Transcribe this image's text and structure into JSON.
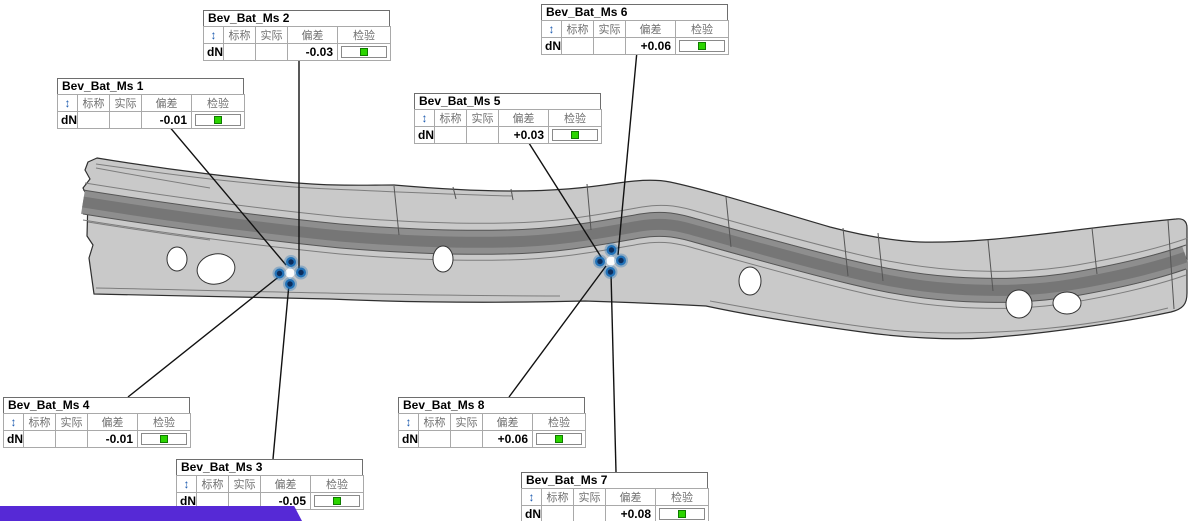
{
  "report": {
    "row_label": "dN",
    "columns": {
      "direction": "↕",
      "nominal": "标称",
      "actual": "实际",
      "deviation": "偏差",
      "check": "检验"
    },
    "callouts": [
      {
        "title": "Bev_Bat_Ms 1",
        "nominal": "",
        "actual": "",
        "deviation": "-0.01",
        "check_pass": true
      },
      {
        "title": "Bev_Bat_Ms 2",
        "nominal": "",
        "actual": "",
        "deviation": "-0.03",
        "check_pass": true
      },
      {
        "title": "Bev_Bat_Ms 3",
        "nominal": "",
        "actual": "",
        "deviation": "-0.05",
        "check_pass": true
      },
      {
        "title": "Bev_Bat_Ms 4",
        "nominal": "",
        "actual": "",
        "deviation": "-0.01",
        "check_pass": true
      },
      {
        "title": "Bev_Bat_Ms 5",
        "nominal": "",
        "actual": "",
        "deviation": "+0.03",
        "check_pass": true
      },
      {
        "title": "Bev_Bat_Ms 6",
        "nominal": "",
        "actual": "",
        "deviation": "+0.06",
        "check_pass": true
      },
      {
        "title": "Bev_Bat_Ms 7",
        "nominal": "",
        "actual": "",
        "deviation": "+0.08",
        "check_pass": true
      },
      {
        "title": "Bev_Bat_Ms 8",
        "nominal": "",
        "actual": "",
        "deviation": "+0.06",
        "check_pass": true
      }
    ]
  },
  "colors": {
    "accent_bar": "#5629d6",
    "pass_green": "#2bd400",
    "pass_green_border": "#0f7a00",
    "direction_arrow_blue": "#1d5bb0",
    "point_fill": "#0c2d5c",
    "point_ring": "#2272b8",
    "part_body": "#c9c9c9",
    "part_channel": "#8e8e8e",
    "leader_line": "#111111"
  }
}
